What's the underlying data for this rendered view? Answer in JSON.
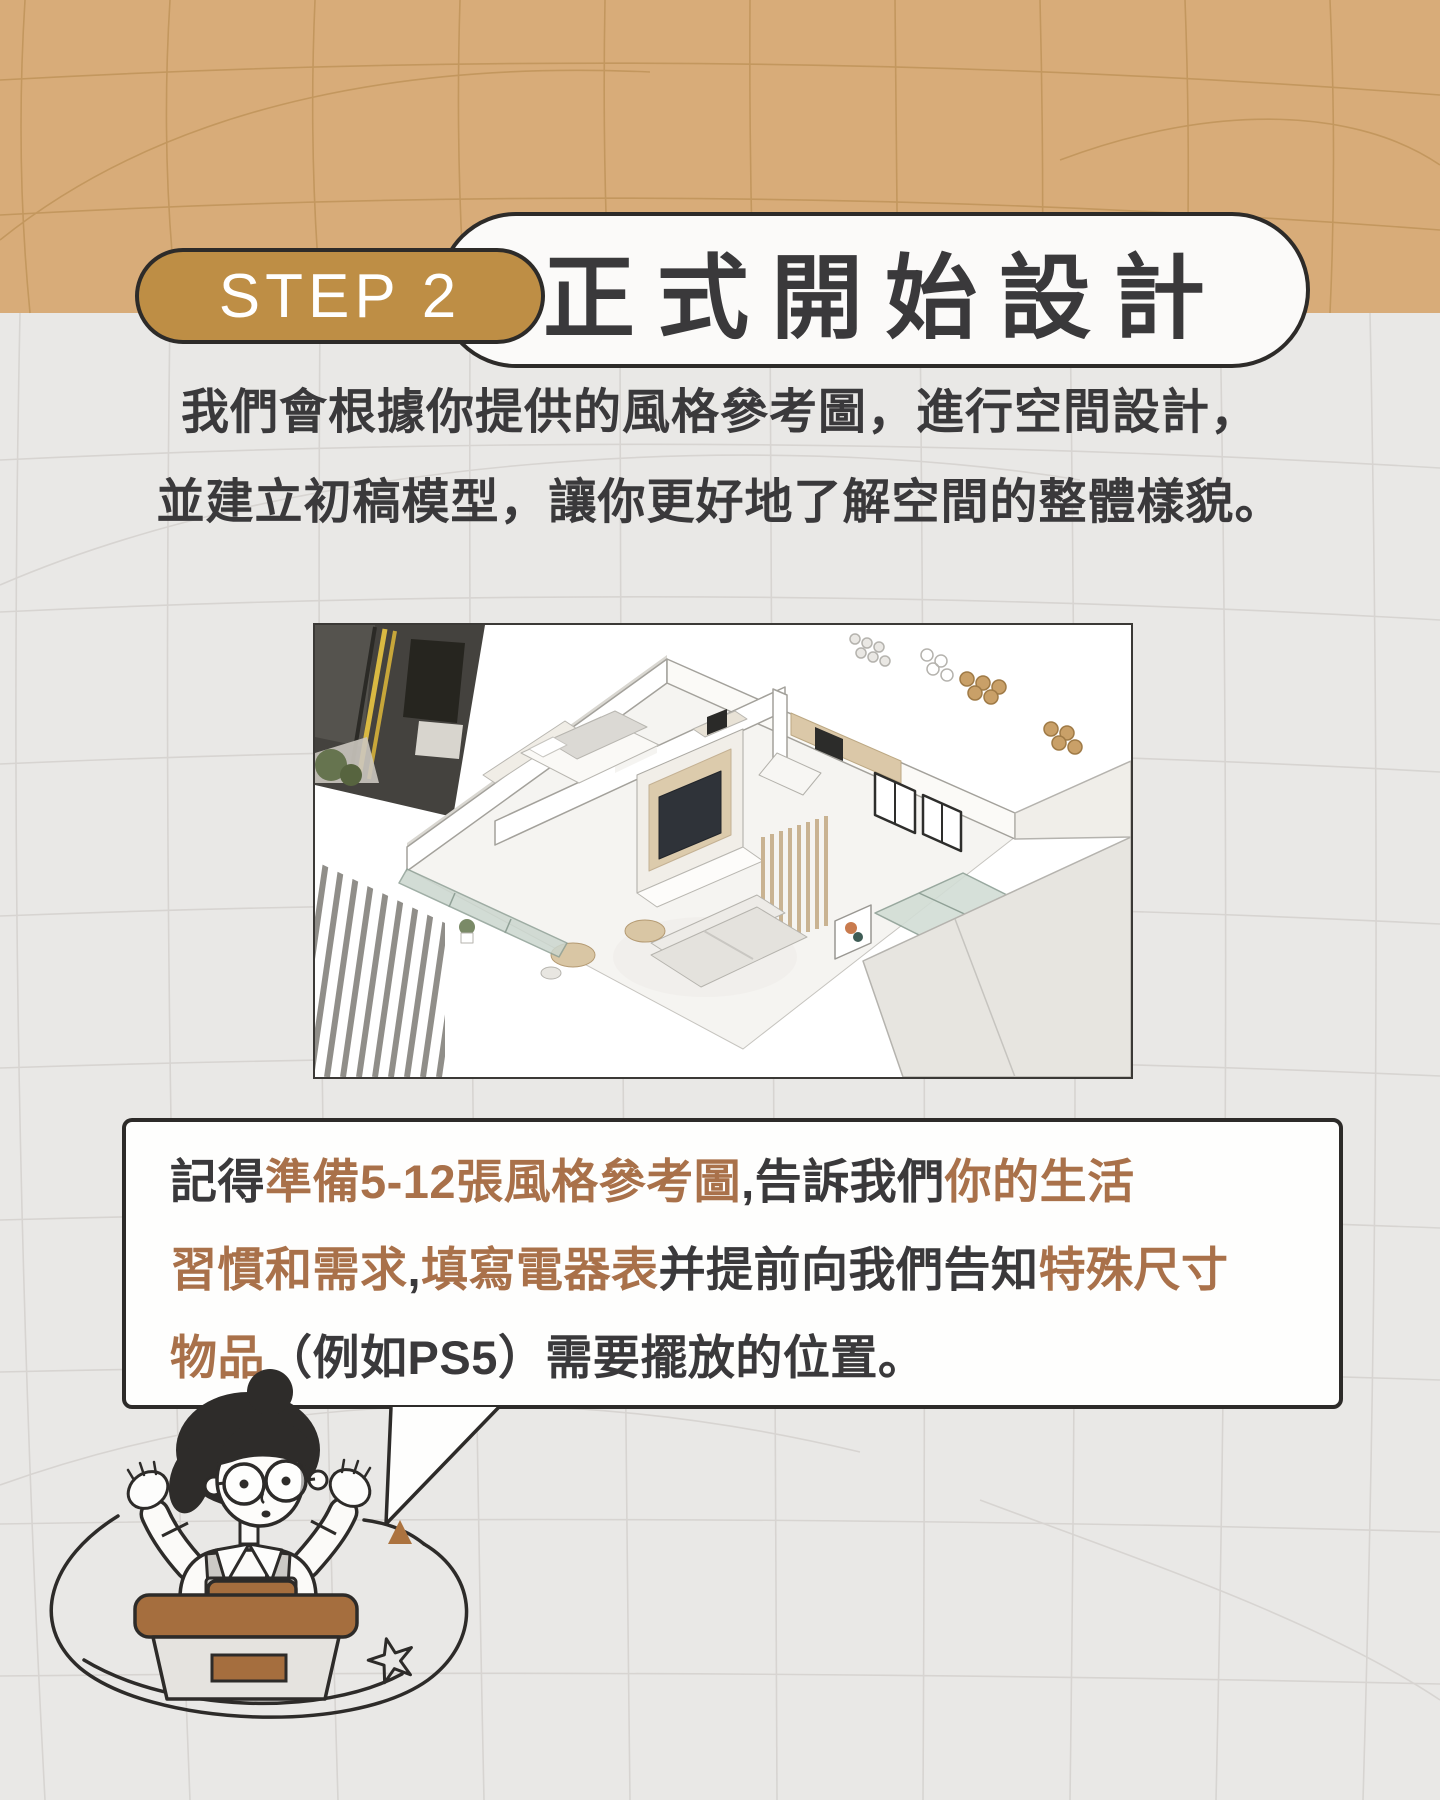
{
  "colors": {
    "page_bg": "#E9E8E6",
    "tan_band": "#D8AC79",
    "grid_tan": "#BC9156",
    "grid_gray": "#D4D1CE",
    "badge_gold": "#BE8E45",
    "outline_dark": "#2D2B29",
    "card_white": "#FBFAF9",
    "text_dark": "#3A393B",
    "accent_brown": "#A9714A",
    "desk_brown": "#A56E3E"
  },
  "header": {
    "step_label": "STEP 2",
    "title": "正式開始設計"
  },
  "intro": {
    "line1": "我們會根據你提供的風格參考圖，進行空間設計，",
    "line2": "並建立初稿模型，讓你更好地了解空間的整體樣貌。"
  },
  "bubble": {
    "lines": [
      {
        "segments": [
          {
            "text": "記得",
            "highlight": false
          },
          {
            "text": "準備5-12張風格參考圖",
            "highlight": true
          },
          {
            "text": ",告訴我們",
            "highlight": false
          },
          {
            "text": "你的生活",
            "highlight": true
          }
        ]
      },
      {
        "segments": [
          {
            "text": "習慣和需求",
            "highlight": true
          },
          {
            "text": ",",
            "highlight": false
          },
          {
            "text": "填寫電器表",
            "highlight": true
          },
          {
            "text": "并提前向我們告知",
            "highlight": false
          },
          {
            "text": "特殊尺寸",
            "highlight": true
          }
        ]
      },
      {
        "segments": [
          {
            "text": "物品",
            "highlight": true
          },
          {
            "text": "（例如PS5）需要擺放的位置。",
            "highlight": false
          }
        ]
      }
    ]
  },
  "illustrations": {
    "render": "3d-apartment-model-birdseye",
    "mascot": "designer-at-desk-shrugging"
  }
}
